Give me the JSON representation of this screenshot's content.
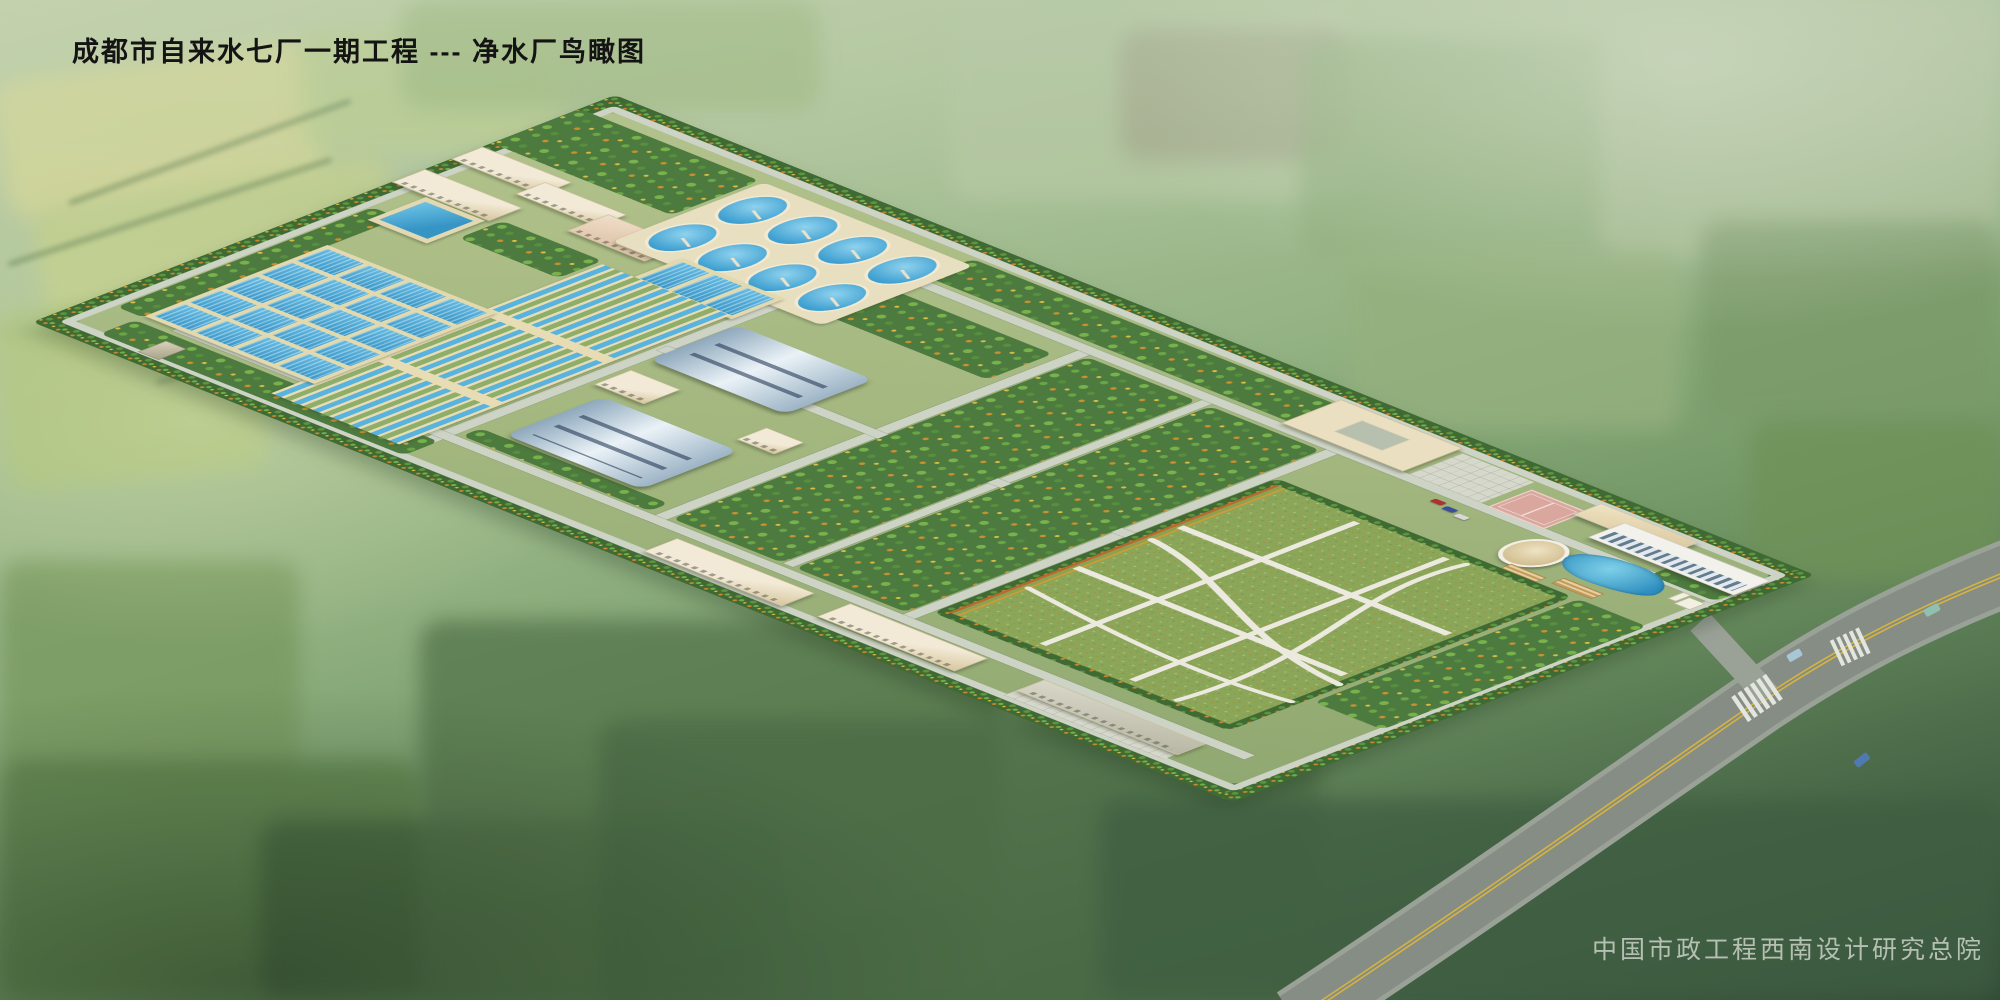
{
  "scene": {
    "type": "architectural aerial rendering",
    "title": "成都市自来水七厂一期工程 --- 净水厂鸟瞰图",
    "credit": "中国市政工程西南设计研究总院",
    "palette": {
      "haze_green": "#b7c8a6",
      "field_yellow": "#d6d795",
      "field_green": "#8fae7c",
      "field_dark": "#46663f",
      "water_blue": "#4aaede",
      "water_deep": "#2f8fc0",
      "basin_wall_beige": "#e6dcb4",
      "building_beige": "#efe6cf",
      "filter_hall_roof": "#b9ccd8",
      "highway_gray": "#868d85",
      "site_road_gray": "#cdd3c5",
      "hedge_green": "#3f6a33",
      "orchard_green": "#4d7a3e",
      "autumn_orange": "#c89030",
      "lawn_green": "#8ba559",
      "court_pink": "#d9a79e",
      "road_centerline_yellow": "#d9b53e"
    },
    "elements": [
      "perimeter-hedge",
      "workshop-buildings",
      "chemical-building",
      "circular-clarifiers",
      "small-round-tanks",
      "elevated-square-pool",
      "flocculation-cell-basins",
      "sedimentation-strip-basins",
      "filter-hall-north",
      "filter-hall-south",
      "orchard-blocks",
      "central-lawn",
      "lawn-paths",
      "basketball-court",
      "office-building",
      "admin-building",
      "round-pavilion",
      "pond",
      "pergolas",
      "parking-cars",
      "garage-buildings",
      "entrance-gate",
      "main-road",
      "crosswalks",
      "road-cars"
    ]
  }
}
